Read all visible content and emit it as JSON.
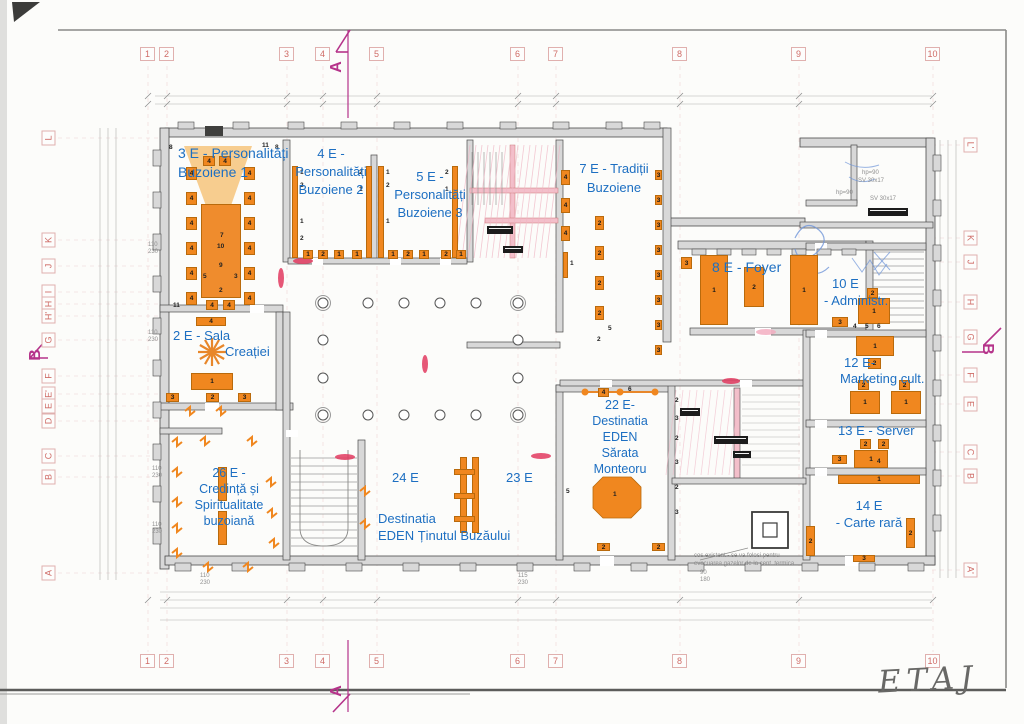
{
  "title_handwritten": "ETAJ",
  "colors": {
    "accent_orange": "#f0871f",
    "cone_orange": "#f6c883",
    "label_blue": "#1d6fc2",
    "grid_pink": "#cf6b66",
    "marker_magenta": "#b5338a",
    "wall_gray": "#d8d8d8",
    "hatch_pink": "#f3bfca",
    "sketch_blue": "#6f95d8",
    "red_accent": "#e23a5f"
  },
  "grid": {
    "top_numbers": [
      "1",
      "2",
      "3",
      "4",
      "5",
      "6",
      "7",
      "8",
      "9",
      "10"
    ],
    "bottom_numbers": [
      "1",
      "2",
      "3",
      "4",
      "5",
      "6",
      "7",
      "8",
      "9",
      "10"
    ],
    "left_letters": [
      "L",
      "K",
      "J",
      "I",
      "H",
      "H'",
      "G",
      "F",
      "E'",
      "E",
      "D",
      "C",
      "B",
      "A"
    ],
    "right_letters": [
      "L'",
      "K",
      "J",
      "H",
      "G",
      "F",
      "E",
      "C",
      "B",
      "A'"
    ]
  },
  "section_markers": {
    "top": "A",
    "bottom": "A",
    "left": "B",
    "right": "B"
  },
  "rooms": [
    {
      "id": "3e",
      "lines": [
        "3 E - Personalități",
        "Buzoiene 1"
      ]
    },
    {
      "id": "4e",
      "lines": [
        "4 E -",
        "Personalități",
        "Buzoiene 2"
      ]
    },
    {
      "id": "5e",
      "lines": [
        "5 E -",
        "Personalități",
        "Buzoiene 3"
      ]
    },
    {
      "id": "7e",
      "lines": [
        "7 E - Tradiții",
        "Buzoiene"
      ]
    },
    {
      "id": "8e",
      "lines": [
        "8 E - Foyer"
      ]
    },
    {
      "id": "10e",
      "lines": [
        "10 E",
        "- Administr."
      ]
    },
    {
      "id": "12e",
      "lines": [
        "12 E-",
        "Marketing cult."
      ]
    },
    {
      "id": "13e",
      "lines": [
        "13 E - Server"
      ]
    },
    {
      "id": "14e",
      "lines": [
        "14 E",
        "- Carte rară"
      ]
    },
    {
      "id": "2e",
      "lines": [
        "2 E - Sala",
        "Creației"
      ]
    },
    {
      "id": "26e",
      "lines": [
        "26 E -",
        "Credință și",
        "Spiritualitate",
        "buzoiană"
      ]
    },
    {
      "id": "24e",
      "lines": [
        "24 E"
      ]
    },
    {
      "id": "23e",
      "lines": [
        "23 E"
      ]
    },
    {
      "id": "eden",
      "lines": [
        "Destinatia",
        "EDEN Ținutul Buzăului"
      ]
    },
    {
      "id": "22e",
      "lines": [
        "22 E-",
        "Destinatia",
        "EDEN",
        "Sărata",
        "Monteoru"
      ]
    }
  ],
  "furniture": [
    {
      "kind": "table",
      "x": 201,
      "y": 204,
      "w": 40,
      "h": 94,
      "n": ""
    },
    {
      "x": 186,
      "y": 167,
      "w": 11,
      "h": 13,
      "n": "4"
    },
    {
      "x": 186,
      "y": 192,
      "w": 11,
      "h": 13,
      "n": "4"
    },
    {
      "x": 186,
      "y": 217,
      "w": 11,
      "h": 13,
      "n": "4"
    },
    {
      "x": 186,
      "y": 242,
      "w": 11,
      "h": 13,
      "n": "4"
    },
    {
      "x": 186,
      "y": 267,
      "w": 11,
      "h": 13,
      "n": "4"
    },
    {
      "x": 186,
      "y": 292,
      "w": 11,
      "h": 13,
      "n": "4"
    },
    {
      "x": 244,
      "y": 167,
      "w": 11,
      "h": 13,
      "n": "4"
    },
    {
      "x": 244,
      "y": 192,
      "w": 11,
      "h": 13,
      "n": "4"
    },
    {
      "x": 244,
      "y": 217,
      "w": 11,
      "h": 13,
      "n": "4"
    },
    {
      "x": 244,
      "y": 242,
      "w": 11,
      "h": 13,
      "n": "4"
    },
    {
      "x": 244,
      "y": 267,
      "w": 11,
      "h": 13,
      "n": "4"
    },
    {
      "x": 244,
      "y": 292,
      "w": 11,
      "h": 13,
      "n": "4"
    },
    {
      "x": 203,
      "y": 156,
      "w": 12,
      "h": 10,
      "n": "4"
    },
    {
      "x": 219,
      "y": 156,
      "w": 12,
      "h": 10,
      "n": "4"
    },
    {
      "x": 206,
      "y": 300,
      "w": 12,
      "h": 10,
      "n": "4"
    },
    {
      "x": 223,
      "y": 300,
      "w": 12,
      "h": 10,
      "n": "4"
    },
    {
      "kind": "num",
      "x": 220,
      "y": 232,
      "n": "7"
    },
    {
      "kind": "num",
      "x": 217,
      "y": 243,
      "n": "10"
    },
    {
      "kind": "num",
      "x": 219,
      "y": 262,
      "n": "9"
    },
    {
      "kind": "num",
      "x": 203,
      "y": 273,
      "n": "5"
    },
    {
      "kind": "num",
      "x": 234,
      "y": 273,
      "n": "3"
    },
    {
      "kind": "num",
      "x": 219,
      "y": 287,
      "n": "2"
    },
    {
      "kind": "num",
      "x": 173,
      "y": 302,
      "n": "11"
    },
    {
      "kind": "num",
      "x": 169,
      "y": 144,
      "n": "8"
    },
    {
      "kind": "num",
      "x": 262,
      "y": 142,
      "n": "11"
    },
    {
      "kind": "num",
      "x": 275,
      "y": 144,
      "n": "8"
    },
    {
      "x": 196,
      "y": 317,
      "w": 30,
      "h": 9,
      "n": "4"
    },
    {
      "x": 191,
      "y": 373,
      "w": 42,
      "h": 17,
      "n": "1"
    },
    {
      "x": 166,
      "y": 393,
      "w": 13,
      "h": 9,
      "n": "3"
    },
    {
      "x": 206,
      "y": 393,
      "w": 13,
      "h": 9,
      "n": "2"
    },
    {
      "x": 238,
      "y": 393,
      "w": 13,
      "h": 9,
      "n": "3"
    },
    {
      "kind": "strip",
      "x": 292,
      "y": 166,
      "w": 6,
      "h": 92
    },
    {
      "kind": "strip",
      "x": 366,
      "y": 166,
      "w": 6,
      "h": 92
    },
    {
      "kind": "num",
      "x": 300,
      "y": 169,
      "n": "1"
    },
    {
      "kind": "num",
      "x": 300,
      "y": 182,
      "n": "2"
    },
    {
      "kind": "num",
      "x": 300,
      "y": 218,
      "n": "1"
    },
    {
      "kind": "num",
      "x": 300,
      "y": 235,
      "n": "2"
    },
    {
      "kind": "num",
      "x": 359,
      "y": 169,
      "n": "2"
    },
    {
      "kind": "num",
      "x": 359,
      "y": 186,
      "n": "1"
    },
    {
      "x": 303,
      "y": 250,
      "w": 10,
      "h": 9,
      "n": "1"
    },
    {
      "x": 318,
      "y": 250,
      "w": 10,
      "h": 9,
      "n": "2"
    },
    {
      "x": 334,
      "y": 250,
      "w": 10,
      "h": 9,
      "n": "1"
    },
    {
      "x": 352,
      "y": 250,
      "w": 10,
      "h": 9,
      "n": "1"
    },
    {
      "kind": "strip",
      "x": 378,
      "y": 166,
      "w": 6,
      "h": 92
    },
    {
      "kind": "strip",
      "x": 452,
      "y": 166,
      "w": 6,
      "h": 92
    },
    {
      "kind": "num",
      "x": 386,
      "y": 169,
      "n": "1"
    },
    {
      "kind": "num",
      "x": 386,
      "y": 182,
      "n": "2"
    },
    {
      "kind": "num",
      "x": 386,
      "y": 218,
      "n": "1"
    },
    {
      "kind": "num",
      "x": 445,
      "y": 169,
      "n": "2"
    },
    {
      "kind": "num",
      "x": 445,
      "y": 186,
      "n": "1"
    },
    {
      "x": 388,
      "y": 250,
      "w": 10,
      "h": 9,
      "n": "1"
    },
    {
      "x": 403,
      "y": 250,
      "w": 10,
      "h": 9,
      "n": "2"
    },
    {
      "x": 419,
      "y": 250,
      "w": 10,
      "h": 9,
      "n": "1"
    },
    {
      "x": 441,
      "y": 250,
      "w": 10,
      "h": 9,
      "n": "2"
    },
    {
      "x": 456,
      "y": 250,
      "w": 10,
      "h": 9,
      "n": "1"
    },
    {
      "x": 561,
      "y": 170,
      "w": 9,
      "h": 15,
      "n": "4"
    },
    {
      "x": 561,
      "y": 198,
      "w": 9,
      "h": 15,
      "n": "4"
    },
    {
      "x": 561,
      "y": 226,
      "w": 9,
      "h": 15,
      "n": "4"
    },
    {
      "kind": "strip",
      "x": 563,
      "y": 252,
      "w": 5,
      "h": 26
    },
    {
      "kind": "num",
      "x": 570,
      "y": 260,
      "n": "1"
    },
    {
      "x": 595,
      "y": 216,
      "w": 9,
      "h": 14,
      "n": "2"
    },
    {
      "x": 595,
      "y": 246,
      "w": 9,
      "h": 14,
      "n": "2"
    },
    {
      "x": 595,
      "y": 276,
      "w": 9,
      "h": 14,
      "n": "2"
    },
    {
      "x": 595,
      "y": 306,
      "w": 9,
      "h": 14,
      "n": "2"
    },
    {
      "kind": "num",
      "x": 597,
      "y": 336,
      "n": "2"
    },
    {
      "kind": "num",
      "x": 608,
      "y": 325,
      "n": "5"
    },
    {
      "x": 655,
      "y": 170,
      "w": 7,
      "h": 10,
      "n": "3"
    },
    {
      "x": 655,
      "y": 195,
      "w": 7,
      "h": 10,
      "n": "3"
    },
    {
      "x": 655,
      "y": 220,
      "w": 7,
      "h": 10,
      "n": "3"
    },
    {
      "x": 655,
      "y": 245,
      "w": 7,
      "h": 10,
      "n": "3"
    },
    {
      "x": 655,
      "y": 270,
      "w": 7,
      "h": 10,
      "n": "3"
    },
    {
      "x": 655,
      "y": 295,
      "w": 7,
      "h": 10,
      "n": "3"
    },
    {
      "x": 655,
      "y": 320,
      "w": 7,
      "h": 10,
      "n": "3"
    },
    {
      "x": 655,
      "y": 345,
      "w": 7,
      "h": 10,
      "n": "3"
    },
    {
      "x": 700,
      "y": 255,
      "w": 28,
      "h": 70,
      "n": "1"
    },
    {
      "x": 744,
      "y": 267,
      "w": 20,
      "h": 40,
      "n": "2"
    },
    {
      "x": 790,
      "y": 255,
      "w": 28,
      "h": 70,
      "n": "1"
    },
    {
      "x": 681,
      "y": 257,
      "w": 11,
      "h": 12,
      "n": "3"
    },
    {
      "x": 867,
      "y": 288,
      "w": 11,
      "h": 10,
      "n": "2"
    },
    {
      "x": 858,
      "y": 298,
      "w": 32,
      "h": 26,
      "n": "1"
    },
    {
      "x": 832,
      "y": 317,
      "w": 16,
      "h": 10,
      "n": "3"
    },
    {
      "kind": "num",
      "x": 853,
      "y": 323,
      "n": "4"
    },
    {
      "kind": "num",
      "x": 865,
      "y": 323,
      "n": "5"
    },
    {
      "kind": "num",
      "x": 877,
      "y": 323,
      "n": "6"
    },
    {
      "x": 856,
      "y": 336,
      "w": 38,
      "h": 20,
      "n": "1"
    },
    {
      "x": 868,
      "y": 358,
      "w": 13,
      "h": 11,
      "n": "2"
    },
    {
      "x": 858,
      "y": 380,
      "w": 11,
      "h": 10,
      "n": "2"
    },
    {
      "x": 899,
      "y": 380,
      "w": 11,
      "h": 10,
      "n": "2"
    },
    {
      "x": 850,
      "y": 391,
      "w": 30,
      "h": 23,
      "n": "1"
    },
    {
      "x": 891,
      "y": 391,
      "w": 30,
      "h": 23,
      "n": "1"
    },
    {
      "x": 860,
      "y": 439,
      "w": 11,
      "h": 10,
      "n": "2"
    },
    {
      "x": 878,
      "y": 439,
      "w": 11,
      "h": 10,
      "n": "2"
    },
    {
      "x": 854,
      "y": 450,
      "w": 34,
      "h": 18,
      "n": "1"
    },
    {
      "x": 832,
      "y": 455,
      "w": 15,
      "h": 9,
      "n": "3"
    },
    {
      "kind": "num",
      "x": 877,
      "y": 458,
      "n": "4"
    },
    {
      "x": 838,
      "y": 475,
      "w": 82,
      "h": 9,
      "n": "1"
    },
    {
      "x": 806,
      "y": 526,
      "w": 9,
      "h": 30,
      "n": "2"
    },
    {
      "x": 906,
      "y": 518,
      "w": 9,
      "h": 30,
      "n": "2"
    },
    {
      "x": 853,
      "y": 555,
      "w": 22,
      "h": 7,
      "n": "3"
    },
    {
      "x": 598,
      "y": 388,
      "w": 11,
      "h": 9,
      "n": "4"
    },
    {
      "kind": "num",
      "x": 628,
      "y": 386,
      "n": "6"
    },
    {
      "kind": "num",
      "x": 613,
      "y": 491,
      "n": "1"
    },
    {
      "kind": "num",
      "x": 675,
      "y": 397,
      "n": "2"
    },
    {
      "kind": "num",
      "x": 675,
      "y": 415,
      "n": "3"
    },
    {
      "kind": "num",
      "x": 675,
      "y": 435,
      "n": "2"
    },
    {
      "kind": "num",
      "x": 675,
      "y": 459,
      "n": "3"
    },
    {
      "kind": "num",
      "x": 675,
      "y": 484,
      "n": "2"
    },
    {
      "kind": "num",
      "x": 675,
      "y": 509,
      "n": "3"
    },
    {
      "x": 597,
      "y": 543,
      "w": 13,
      "h": 8,
      "n": "2"
    },
    {
      "x": 652,
      "y": 543,
      "w": 13,
      "h": 8,
      "n": "2"
    },
    {
      "kind": "strip",
      "x": 460,
      "y": 457,
      "w": 7,
      "h": 76
    },
    {
      "kind": "strip",
      "x": 472,
      "y": 457,
      "w": 7,
      "h": 76
    },
    {
      "kind": "strip",
      "x": 454,
      "y": 469,
      "w": 21,
      "h": 6
    },
    {
      "kind": "strip",
      "x": 454,
      "y": 493,
      "w": 21,
      "h": 6
    },
    {
      "kind": "strip",
      "x": 454,
      "y": 516,
      "w": 21,
      "h": 6
    },
    {
      "kind": "num",
      "x": 566,
      "y": 488,
      "n": "5"
    },
    {
      "kind": "strip",
      "x": 218,
      "y": 467,
      "w": 9,
      "h": 34
    },
    {
      "kind": "strip",
      "x": 218,
      "y": 511,
      "w": 9,
      "h": 34
    }
  ],
  "annotations": {
    "note_line1": "cos existent - se va folosi pentru",
    "note_line2": "evacuarea gazelor de la cent. termica",
    "small_texts": [
      {
        "t": "hp=90",
        "x": 862,
        "y": 170
      },
      {
        "t": "SV 30x17",
        "x": 858,
        "y": 178
      },
      {
        "t": "hp=90",
        "x": 836,
        "y": 190
      },
      {
        "t": "SV 30x17",
        "x": 870,
        "y": 196
      },
      {
        "t": "110",
        "x": 148,
        "y": 242
      },
      {
        "t": "230",
        "x": 148,
        "y": 249
      },
      {
        "t": "110",
        "x": 148,
        "y": 330
      },
      {
        "t": "230",
        "x": 148,
        "y": 337
      },
      {
        "t": "110",
        "x": 152,
        "y": 466
      },
      {
        "t": "230",
        "x": 152,
        "y": 473
      },
      {
        "t": "110",
        "x": 152,
        "y": 522
      },
      {
        "t": "230",
        "x": 152,
        "y": 529
      },
      {
        "t": "110",
        "x": 200,
        "y": 573
      },
      {
        "t": "230",
        "x": 200,
        "y": 580
      },
      {
        "t": "115",
        "x": 518,
        "y": 573
      },
      {
        "t": "230",
        "x": 518,
        "y": 580
      },
      {
        "t": "90",
        "x": 700,
        "y": 570
      },
      {
        "t": "180",
        "x": 700,
        "y": 577
      }
    ]
  }
}
